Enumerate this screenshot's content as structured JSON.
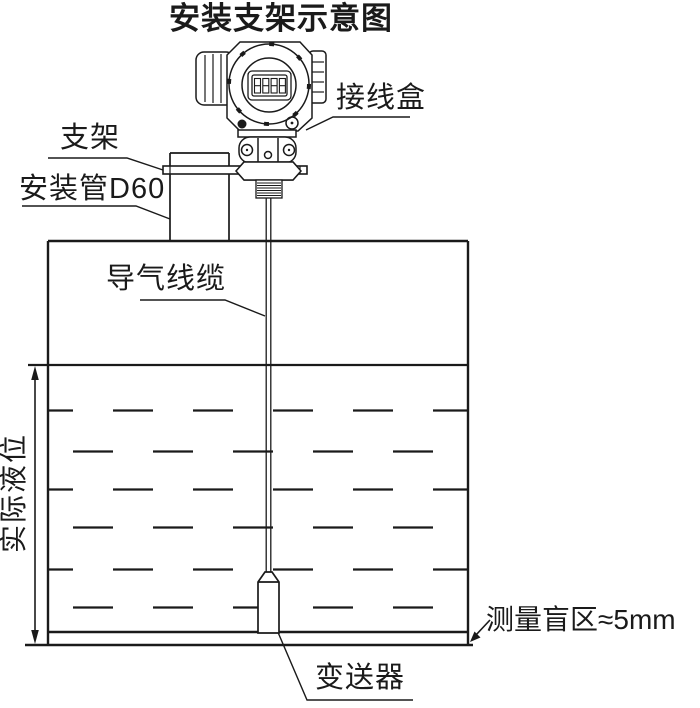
{
  "title": "安装支架示意图",
  "labels": {
    "junction_box": "接线盒",
    "bracket": "支架",
    "mounting_pipe": "安装管D60",
    "air_cable": "导气线缆",
    "actual_level": "实际液位",
    "blind_zone": "测量盲区≈5mm",
    "transmitter": "变送器"
  },
  "device": {
    "lcd_digits": "8888"
  },
  "colors": {
    "line": "#1a1a1a",
    "background": "#ffffff"
  }
}
